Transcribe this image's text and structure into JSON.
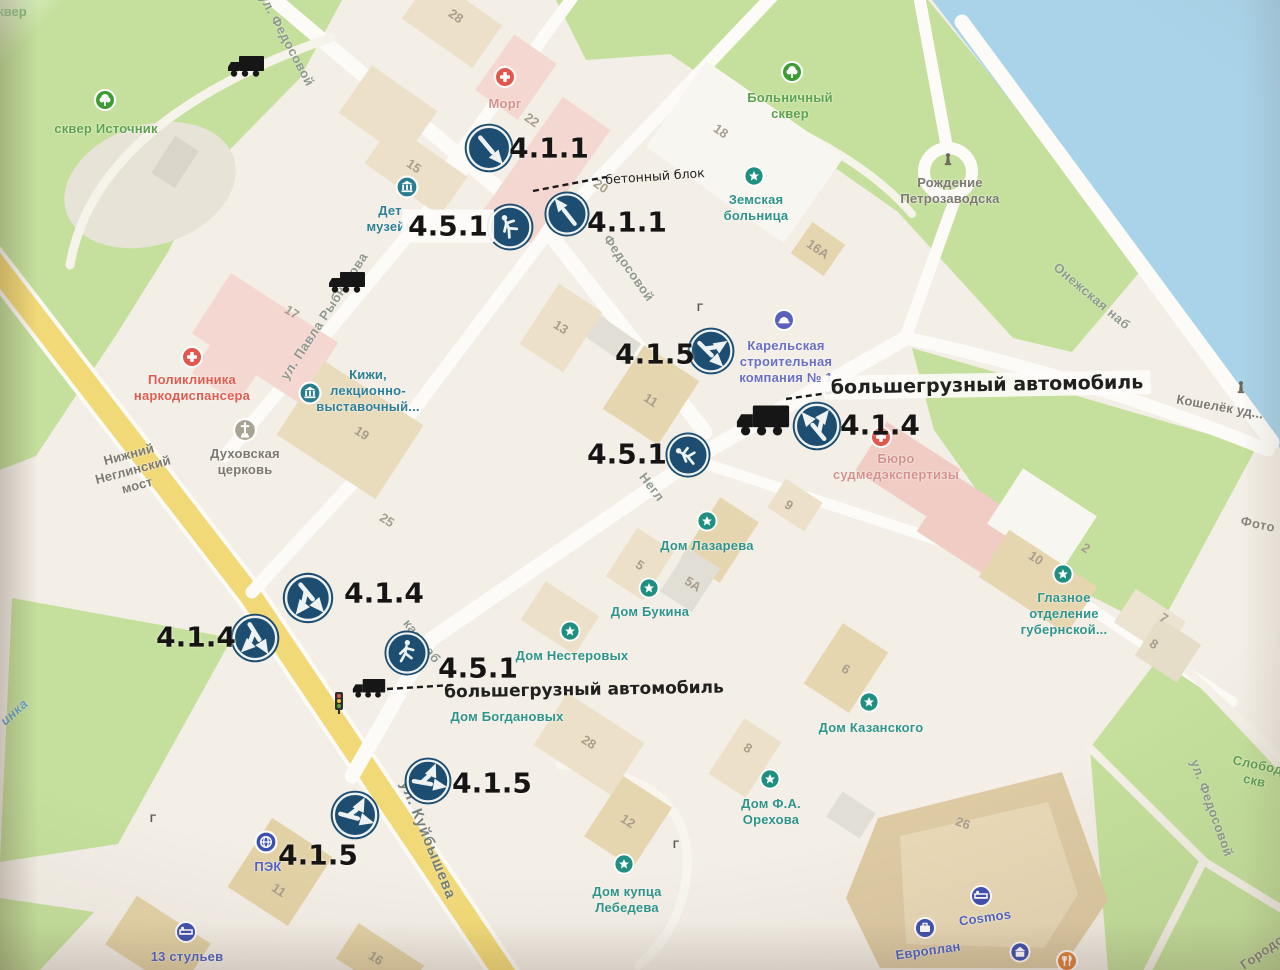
{
  "photo": {
    "corner_label": "сквер"
  },
  "misc": {
    "gate_glyph": "Г"
  },
  "signs": [
    {
      "code": "4.1.1",
      "kind": "straight",
      "x": 489,
      "y": 148,
      "d": 54,
      "rot": 140
    },
    {
      "code": "4.1.1",
      "kind": "straight",
      "x": 567,
      "y": 214,
      "d": 50,
      "rot": -38
    },
    {
      "code": "4.5.1",
      "kind": "pedestrian",
      "x": 510,
      "y": 227,
      "d": 52,
      "rot": -45
    },
    {
      "code": "4.1.5",
      "kind": "straight-or-left",
      "x": 711,
      "y": 351,
      "d": 52,
      "rot": 135
    },
    {
      "code": "4.1.4",
      "kind": "straight-or-right",
      "x": 817,
      "y": 426,
      "d": 54,
      "rot": -40
    },
    {
      "code": "4.5.1",
      "kind": "pedestrian",
      "x": 688,
      "y": 455,
      "d": 50,
      "rot": -80
    },
    {
      "code": "4.1.4",
      "kind": "straight-or-right",
      "x": 308,
      "y": 598,
      "d": 56,
      "rot": 140
    },
    {
      "code": "4.1.4",
      "kind": "straight-or-right",
      "x": 255,
      "y": 638,
      "d": 54,
      "rot": 148
    },
    {
      "code": "4.5.1",
      "kind": "pedestrian",
      "x": 407,
      "y": 653,
      "d": 50,
      "rot": -12
    },
    {
      "code": "4.1.5",
      "kind": "straight-or-left",
      "x": 428,
      "y": 781,
      "d": 52,
      "rot": 100
    },
    {
      "code": "4.1.5",
      "kind": "straight-or-left",
      "x": 355,
      "y": 815,
      "d": 54,
      "rot": 105
    }
  ],
  "sign_labels": [
    {
      "text": "4.1.1",
      "x": 549,
      "y": 148,
      "bg": false
    },
    {
      "text": "4.1.1",
      "x": 627,
      "y": 222,
      "bg": false
    },
    {
      "text": "4.5.1",
      "x": 448,
      "y": 226,
      "bg": true
    },
    {
      "text": "4.1.5",
      "x": 655,
      "y": 354,
      "bg": false
    },
    {
      "text": "4.1.4",
      "x": 880,
      "y": 425,
      "bg": false
    },
    {
      "text": "4.5.1",
      "x": 627,
      "y": 454,
      "bg": false
    },
    {
      "text": "4.1.4",
      "x": 384,
      "y": 593,
      "bg": false
    },
    {
      "text": "4.1.4",
      "x": 196,
      "y": 637,
      "bg": false
    },
    {
      "text": "4.5.1",
      "x": 478,
      "y": 668,
      "bg": false
    },
    {
      "text": "4.1.5",
      "x": 492,
      "y": 783,
      "bg": false
    },
    {
      "text": "4.1.5",
      "x": 318,
      "y": 855,
      "bg": false
    }
  ],
  "annotations": [
    {
      "text": "бетонный блок",
      "x": 655,
      "y": 176,
      "size": 12.5,
      "rot": -4,
      "bold": false,
      "bg": false
    },
    {
      "text": "большегрузный автомобиль",
      "x": 987,
      "y": 385,
      "size": 19,
      "rot": -1,
      "bold": true,
      "bg": true
    },
    {
      "text": "большегрузный автомобиль",
      "x": 584,
      "y": 690,
      "size": 17,
      "rot": -1,
      "bold": true,
      "bg": false
    }
  ],
  "streets": [
    {
      "text": "ул. Федосовой",
      "x": 287,
      "y": 40,
      "rot": 62,
      "cls": ""
    },
    {
      "text": "Федосовой",
      "x": 629,
      "y": 268,
      "rot": 55,
      "cls": ""
    },
    {
      "text": "ул. Павла Рыбникова",
      "x": 324,
      "y": 316,
      "rot": -57,
      "cls": ""
    },
    {
      "text": "Онежская наб",
      "x": 1092,
      "y": 296,
      "rot": 40,
      "cls": ""
    },
    {
      "text": "ул. Куйбышева",
      "x": 428,
      "y": 840,
      "rot": 68,
      "cls": "main"
    },
    {
      "text": "ул. Федосовой",
      "x": 1212,
      "y": 808,
      "rot": 70,
      "cls": ""
    },
    {
      "text": "кая наб",
      "x": 422,
      "y": 641,
      "rot": 52,
      "cls": ""
    },
    {
      "text": "Негл",
      "x": 652,
      "y": 487,
      "rot": 52,
      "cls": ""
    },
    {
      "text": "инка",
      "x": 14,
      "y": 712,
      "rot": -42,
      "cls": "river"
    },
    {
      "text": "Городо",
      "x": 1262,
      "y": 952,
      "rot": -35,
      "cls": "gray"
    },
    {
      "text": "Фото",
      "x": 1258,
      "y": 524,
      "rot": 12,
      "cls": "gray"
    }
  ],
  "pois": [
    {
      "icon": "park",
      "ix": 105,
      "iy": 100,
      "lines": [
        "сквер Источник"
      ],
      "lx": 106,
      "ly": 129,
      "cls": "green",
      "rot": 0
    },
    {
      "icon": "park",
      "ix": 792,
      "iy": 72,
      "lines": [
        "Больничный",
        "сквер"
      ],
      "lx": 790,
      "ly": 106,
      "cls": "green",
      "rot": 0
    },
    {
      "icon": "med",
      "ix": 505,
      "iy": 77,
      "lines": [
        "Морг"
      ],
      "lx": 505,
      "ly": 104,
      "cls": "rose",
      "rot": 0
    },
    {
      "icon": "star",
      "ix": 754,
      "iy": 176,
      "lines": [
        "Земская",
        "больница"
      ],
      "lx": 756,
      "ly": 208,
      "cls": "teal",
      "rot": 0
    },
    {
      "icon": "monument",
      "ix": 948,
      "iy": 160,
      "lines": [
        "Рождение",
        "Петрозаводска"
      ],
      "lx": 950,
      "ly": 191,
      "cls": "gray",
      "rot": 0
    },
    {
      "icon": "monument",
      "ix": 1241,
      "iy": 388,
      "lines": [
        "Кошелёк уд..."
      ],
      "lx": 1220,
      "ly": 407,
      "cls": "gray",
      "rot": 10
    },
    {
      "icon": "med",
      "ix": 192,
      "iy": 357,
      "lines": [
        "Поликлиника",
        "наркодиспансера"
      ],
      "lx": 192,
      "ly": 388,
      "cls": "red",
      "rot": 0
    },
    {
      "icon": "museum",
      "ix": 310,
      "iy": 393,
      "lines": [
        "Кижи,",
        "лекционно-",
        "выставочный..."
      ],
      "lx": 368,
      "ly": 391,
      "cls": "dkteal",
      "rot": 0
    },
    {
      "icon": "church",
      "ix": 245,
      "iy": 430,
      "lines": [
        "Духовская",
        "церковь"
      ],
      "lx": 245,
      "ly": 462,
      "cls": "gray",
      "rot": 0
    },
    {
      "icon": "company",
      "ix": 784,
      "iy": 320,
      "lines": [
        "Карельская",
        "строительная",
        "компания № 1"
      ],
      "lx": 786,
      "ly": 362,
      "cls": "indigo",
      "rot": 0
    },
    {
      "icon": "med",
      "ix": 881,
      "iy": 437,
      "lines": [
        "Бюро",
        "судмедэкспертизы"
      ],
      "lx": 896,
      "ly": 467,
      "cls": "rose",
      "rot": 0
    },
    {
      "icon": "star",
      "ix": 707,
      "iy": 521,
      "lines": [
        "Дом Лазарева"
      ],
      "lx": 707,
      "ly": 546,
      "cls": "teal",
      "rot": 0
    },
    {
      "icon": "star",
      "ix": 649,
      "iy": 588,
      "lines": [
        "Дом Букина"
      ],
      "lx": 650,
      "ly": 612,
      "cls": "teal",
      "rot": 0
    },
    {
      "icon": "star",
      "ix": 570,
      "iy": 631,
      "lines": [
        "Дом Нестеровых"
      ],
      "lx": 572,
      "ly": 656,
      "cls": "teal",
      "rot": 0
    },
    {
      "icon": "none",
      "ix": 0,
      "iy": 0,
      "lines": [
        "Дом Богдановых"
      ],
      "lx": 507,
      "ly": 717,
      "cls": "teal",
      "rot": 0
    },
    {
      "icon": "star",
      "ix": 869,
      "iy": 702,
      "lines": [
        "Дом Казанского"
      ],
      "lx": 871,
      "ly": 728,
      "cls": "teal",
      "rot": 0
    },
    {
      "icon": "star",
      "ix": 770,
      "iy": 779,
      "lines": [
        "Дом Ф.А.",
        "Орехова"
      ],
      "lx": 771,
      "ly": 812,
      "cls": "teal",
      "rot": 0
    },
    {
      "icon": "star",
      "ix": 624,
      "iy": 864,
      "lines": [
        "Дом купца",
        "Лебедева"
      ],
      "lx": 627,
      "ly": 900,
      "cls": "teal",
      "rot": 0
    },
    {
      "icon": "star",
      "ix": 1063,
      "iy": 574,
      "lines": [
        "Глазное",
        "отделение",
        "губернской..."
      ],
      "lx": 1064,
      "ly": 614,
      "cls": "teal",
      "rot": 0
    },
    {
      "icon": "pek",
      "ix": 266,
      "iy": 842,
      "lines": [
        "ПЭК"
      ],
      "lx": 268,
      "ly": 867,
      "cls": "blue",
      "rot": 0
    },
    {
      "icon": "bed",
      "ix": 186,
      "iy": 932,
      "lines": [
        "13 стульев"
      ],
      "lx": 187,
      "ly": 957,
      "cls": "blue",
      "rot": 0
    },
    {
      "icon": "bed",
      "ix": 981,
      "iy": 896,
      "lines": [
        "Cosmos"
      ],
      "lx": 985,
      "ly": 918,
      "cls": "blue",
      "rot": -8
    },
    {
      "icon": "briefcase",
      "ix": 925,
      "iy": 928,
      "lines": [
        "Европлан"
      ],
      "lx": 928,
      "ly": 951,
      "cls": "blue",
      "rot": -8
    },
    {
      "icon": "bank",
      "ix": 1020,
      "iy": 952,
      "lines": [],
      "lx": 0,
      "ly": 0,
      "cls": "blue",
      "rot": 0
    },
    {
      "icon": "food",
      "ix": 1067,
      "iy": 961,
      "lines": [],
      "lx": 0,
      "ly": 0,
      "cls": "blue",
      "rot": 0
    },
    {
      "icon": "museum",
      "ix": 407,
      "iy": 187,
      "lines": [
        "Дет",
        "музейн"
      ],
      "lx": 390,
      "ly": 219,
      "cls": "dkteal",
      "rot": 0
    },
    {
      "icon": "none",
      "ix": 0,
      "iy": 0,
      "lines": [
        "Нижний",
        "Неглинский",
        "мост"
      ],
      "lx": 133,
      "ly": 470,
      "cls": "gray",
      "rot": -15
    },
    {
      "icon": "none",
      "ix": 0,
      "iy": 0,
      "lines": [
        "Слобод",
        "скв"
      ],
      "lx": 1256,
      "ly": 773,
      "cls": "green",
      "rot": 12
    }
  ],
  "numbers": [
    {
      "t": "28",
      "x": 456,
      "y": 16,
      "r": 35
    },
    {
      "t": "22",
      "x": 532,
      "y": 120,
      "r": 35
    },
    {
      "t": "20",
      "x": 601,
      "y": 186,
      "r": 35
    },
    {
      "t": "15",
      "x": 414,
      "y": 166,
      "r": 35
    },
    {
      "t": "18",
      "x": 721,
      "y": 131,
      "r": 35
    },
    {
      "t": "16А",
      "x": 818,
      "y": 249,
      "r": 35
    },
    {
      "t": "17",
      "x": 292,
      "y": 312,
      "r": 33
    },
    {
      "t": "13",
      "x": 561,
      "y": 327,
      "r": 33
    },
    {
      "t": "19",
      "x": 362,
      "y": 433,
      "r": 33
    },
    {
      "t": "25",
      "x": 387,
      "y": 520,
      "r": 33
    },
    {
      "t": "11",
      "x": 651,
      "y": 400,
      "r": 33
    },
    {
      "t": "9",
      "x": 789,
      "y": 505,
      "r": 33
    },
    {
      "t": "5",
      "x": 640,
      "y": 565,
      "r": 33
    },
    {
      "t": "5А",
      "x": 693,
      "y": 584,
      "r": 33
    },
    {
      "t": "6",
      "x": 846,
      "y": 669,
      "r": 33
    },
    {
      "t": "8",
      "x": 748,
      "y": 748,
      "r": 33
    },
    {
      "t": "28",
      "x": 589,
      "y": 742,
      "r": 33
    },
    {
      "t": "12",
      "x": 628,
      "y": 821,
      "r": 33
    },
    {
      "t": "11",
      "x": 279,
      "y": 890,
      "r": 33
    },
    {
      "t": "16",
      "x": 376,
      "y": 958,
      "r": 33
    },
    {
      "t": "26",
      "x": 963,
      "y": 823,
      "r": 20
    },
    {
      "t": "10",
      "x": 1036,
      "y": 558,
      "r": 33
    },
    {
      "t": "2",
      "x": 1086,
      "y": 548,
      "r": 33
    },
    {
      "t": "7",
      "x": 1164,
      "y": 618,
      "r": 33
    },
    {
      "t": "8",
      "x": 1154,
      "y": 644,
      "r": 33
    }
  ],
  "trucks": [
    {
      "x": 246,
      "y": 66,
      "w": 40
    },
    {
      "x": 347,
      "y": 282,
      "w": 40
    },
    {
      "x": 763,
      "y": 420,
      "w": 58
    },
    {
      "x": 369,
      "y": 688,
      "w": 36
    }
  ],
  "connectors": [
    {
      "x1": 533,
      "y1": 191,
      "x2": 606,
      "y2": 177
    },
    {
      "x1": 786,
      "y1": 399,
      "x2": 856,
      "y2": 389
    },
    {
      "x1": 387,
      "y1": 689,
      "x2": 452,
      "y2": 685
    }
  ],
  "gates": [
    {
      "x": 153,
      "y": 819
    },
    {
      "x": 676,
      "y": 845
    },
    {
      "x": 700,
      "y": 308
    }
  ],
  "traffic_light": {
    "x": 339,
    "y": 703
  },
  "colors": {
    "water": "#a9d3e9",
    "park": "#c4e09c",
    "road_main": "#f2d978",
    "sign_blue": "#1d4e71",
    "poi_teal": "#1e8f80",
    "poi_blue": "#3f51b0",
    "poi_red": "#e2574b",
    "annotation_text": "#20201e"
  }
}
